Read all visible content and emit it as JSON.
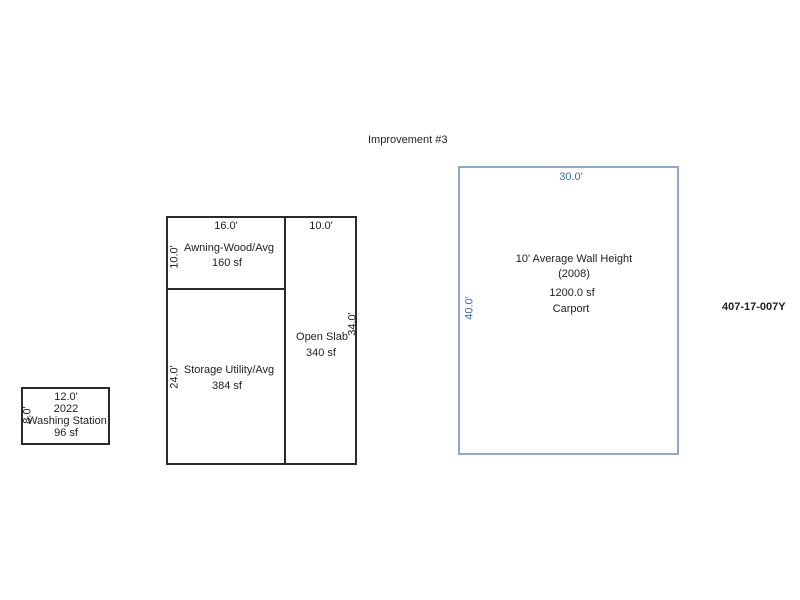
{
  "page": {
    "title": "Improvement #3",
    "parcel_id": "407-17-007Y"
  },
  "colors": {
    "dimension_blue": "#3c6ca8",
    "carport_border": "#8fa9c7",
    "sketch_line_black": "#2a2a2a",
    "background": "#ffffff"
  },
  "structures": {
    "awning": {
      "name": "Awning-Wood/Avg",
      "area": "160 sf",
      "top_dim": "16.0'",
      "left_dim": "10.0'"
    },
    "open_slab": {
      "name": "Open Slab",
      "area": "340 sf",
      "top_dim": "10.0'",
      "right_dim": "34.0'"
    },
    "storage": {
      "name": "Storage Utility/Avg",
      "area": "384 sf",
      "left_dim": "24.0'"
    },
    "washing_station": {
      "year": "2022",
      "name": "Washing Station",
      "area": "96 sf",
      "top_dim": "12.0'",
      "left_dim": "8.0'"
    },
    "carport": {
      "wall_height_note": "10' Average Wall Height",
      "year_note": "(2008)",
      "area": "1200.0 sf",
      "name": "Carport",
      "top_dim": "30.0'",
      "left_dim": "40.0'"
    }
  }
}
